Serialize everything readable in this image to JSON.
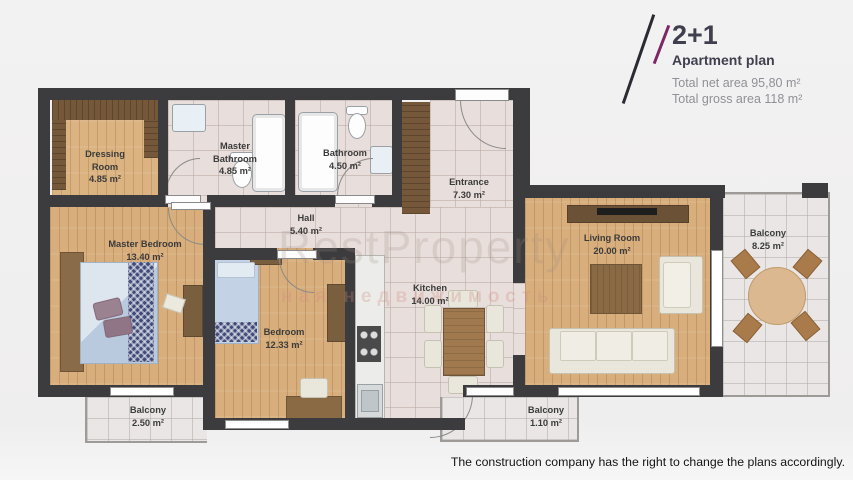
{
  "header": {
    "title": "2+1",
    "subtitle": "Apartment plan",
    "net_area": "Total net area 95,80 m²",
    "gross_area": "Total gross area 118 m²"
  },
  "rooms": {
    "dressing": {
      "name": "Dressing Room",
      "area": "4.85 m²"
    },
    "master_bathroom": {
      "name": "Master Bathroom",
      "area": "4.85 m²"
    },
    "bathroom": {
      "name": "Bathroom",
      "area": "4.50 m²"
    },
    "entrance": {
      "name": "Entrance",
      "area": "7.30 m²"
    },
    "hall": {
      "name": "Hall",
      "area": "5.40 m²"
    },
    "master_bedroom": {
      "name": "Master Bedroom",
      "area": "13.40 m²"
    },
    "bedroom": {
      "name": "Bedroom",
      "area": "12.33 m²"
    },
    "kitchen": {
      "name": "Kitchen",
      "area": "14.00 m²"
    },
    "living_room": {
      "name": "Living Room",
      "area": "20.00 m²"
    },
    "balcony_right": {
      "name": "Balcony",
      "area": "8.25 m²"
    },
    "balcony_bottom_left": {
      "name": "Balcony",
      "area": "2.50 m²"
    },
    "balcony_bottom_middle": {
      "name": "Balcony",
      "area": "1.10 m²"
    }
  },
  "watermark": {
    "line1": "RestProperty",
    "line2": "ная недвижимость"
  },
  "footer": {
    "disclaimer": "The construction company has the right to change the plans accordingly."
  },
  "colors": {
    "accent": "#7d2766",
    "wall": "#3c3c3e"
  }
}
